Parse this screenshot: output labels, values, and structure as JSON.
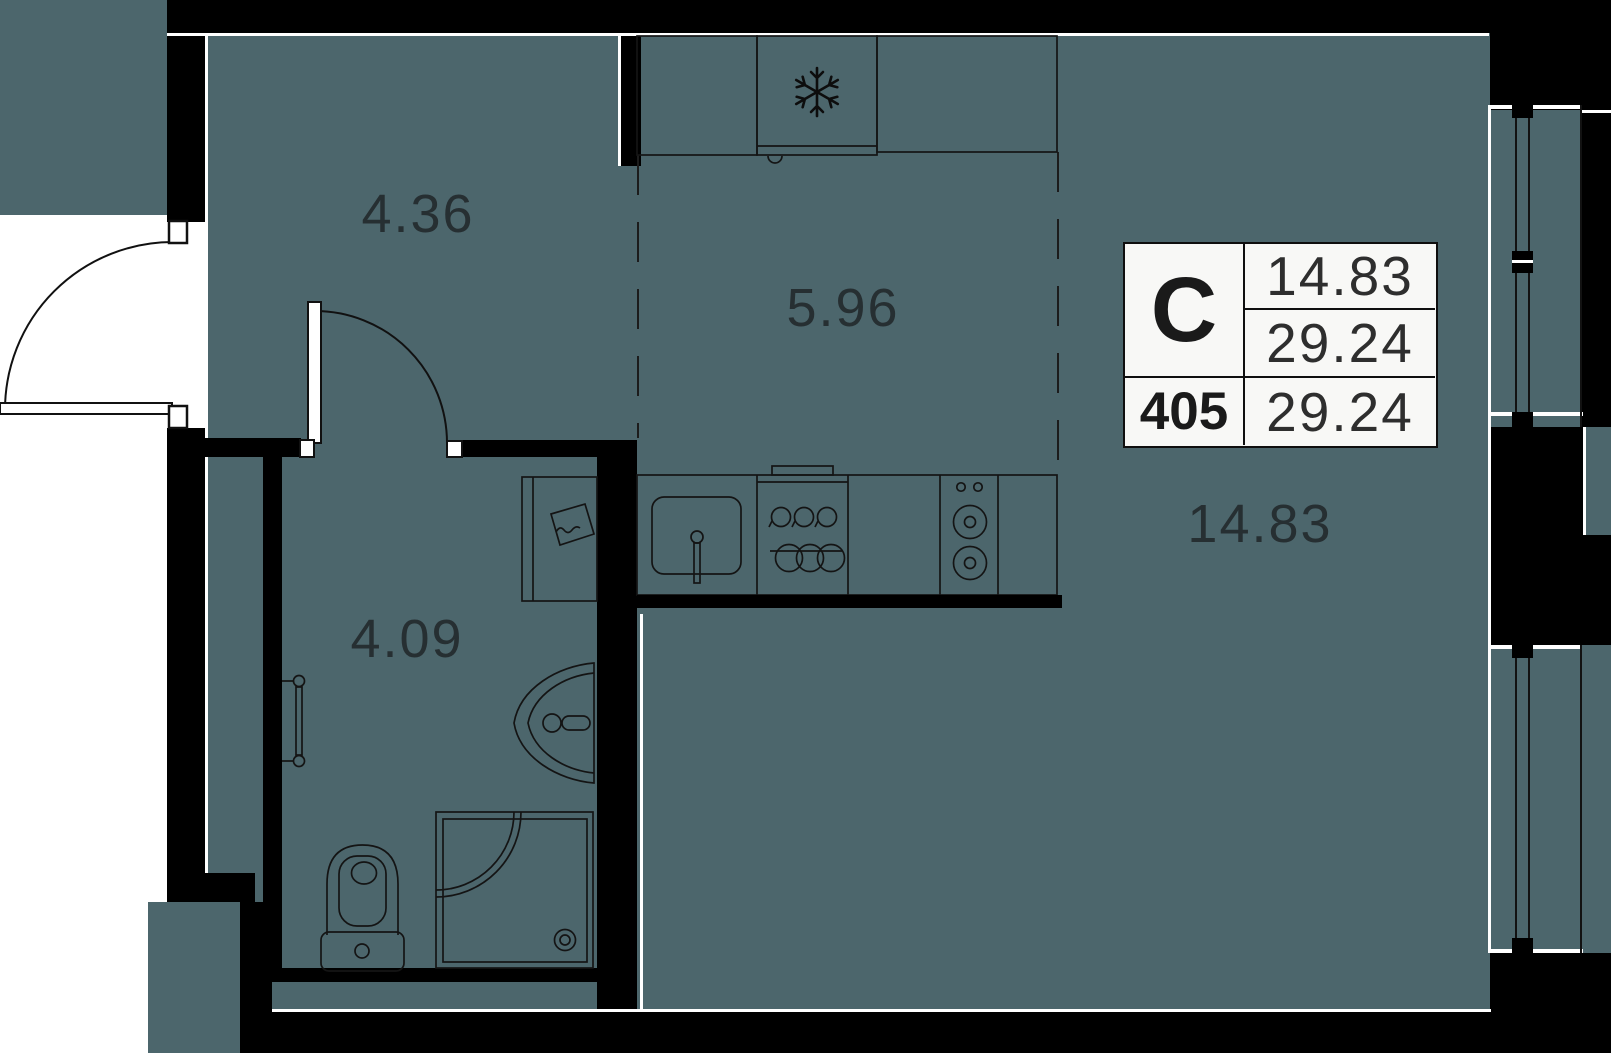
{
  "colors": {
    "floor": "#4c666c",
    "wall": "#000000",
    "background": "#ffffff",
    "line": "#121212",
    "label_text": "#242b2e",
    "table_background": "#f8f8f6"
  },
  "rooms": [
    {
      "id": "hallway",
      "area_label": "4.36"
    },
    {
      "id": "kitchen",
      "area_label": "5.96"
    },
    {
      "id": "bathroom",
      "area_label": "4.09"
    },
    {
      "id": "living",
      "area_label": "14.83"
    }
  ],
  "info_table": {
    "type_label": "С",
    "unit_number": "405",
    "living_area": "14.83",
    "total_area": "29.24",
    "total_area_repeat": "29.24"
  },
  "fixtures": [
    "entry-door",
    "interior-door",
    "kitchen-cabinets",
    "fridge-snowflake-icon",
    "kitchen-sink",
    "faucet",
    "cooktop",
    "stove-burners",
    "washing-machine",
    "towel-rail",
    "bathroom-sink",
    "toilet",
    "shower",
    "window-upper",
    "window-lower"
  ]
}
